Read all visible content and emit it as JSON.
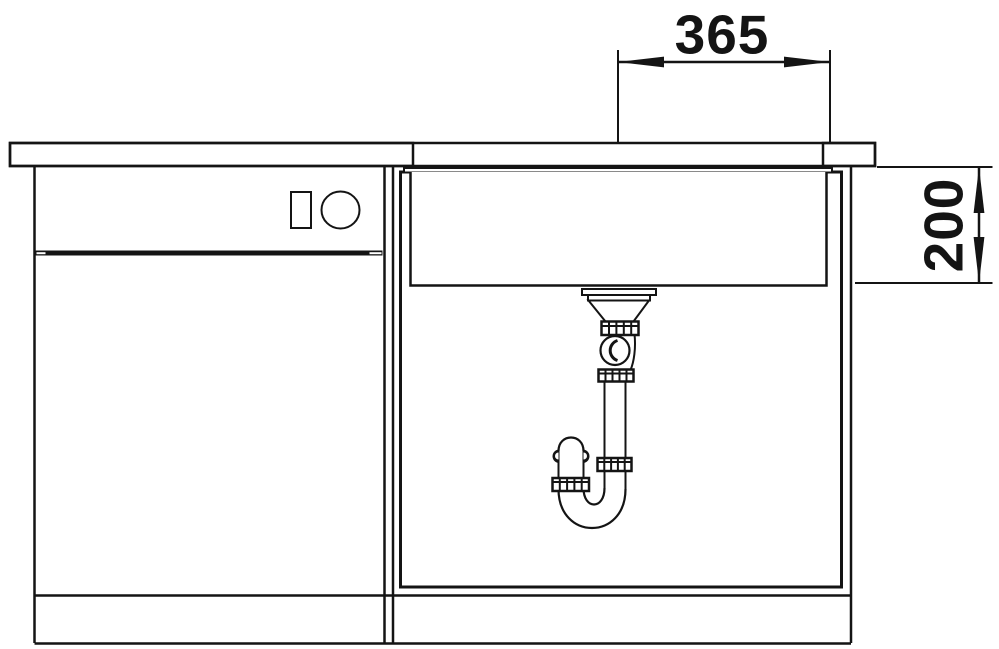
{
  "drawing": {
    "background": "#ffffff",
    "line_color": "#141414",
    "dim_width": "365",
    "dim_depth": "200"
  }
}
